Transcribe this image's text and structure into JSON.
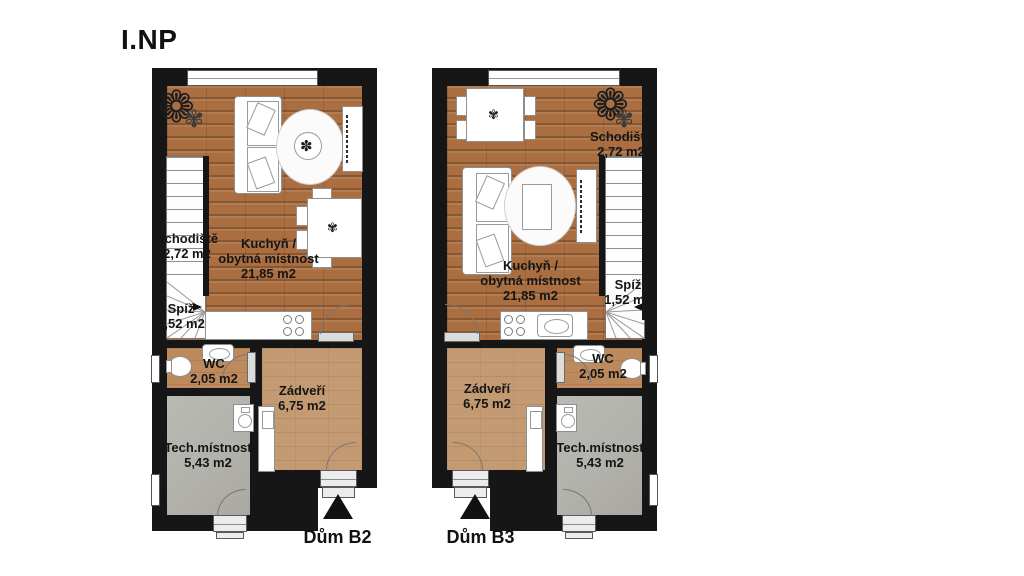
{
  "title": "I.NP",
  "units": [
    {
      "house_label": "Dům B2",
      "rooms": {
        "schodiste": {
          "name": "Schodiště",
          "area": "2,72 m2"
        },
        "kuchyn": {
          "line1": "Kuchyň /",
          "line2": "obytná místnost",
          "area": "21,85 m2"
        },
        "spiz": {
          "name": "Spíž",
          "area": "1,52 m2"
        },
        "wc": {
          "name": "WC",
          "area": "2,05 m2"
        },
        "zadveri": {
          "name": "Zádveří",
          "area": "6,75 m2"
        },
        "tech": {
          "name": "Tech.místnost",
          "area": "5,43 m2"
        }
      }
    },
    {
      "house_label": "Dům B3",
      "rooms": {
        "schodiste": {
          "name": "Schodiště",
          "area": "2,72 m2"
        },
        "kuchyn": {
          "line1": "Kuchyň /",
          "line2": "obytná místnost",
          "area": "21,85 m2"
        },
        "spiz": {
          "name": "Spíž",
          "area": "1,52 m2"
        },
        "wc": {
          "name": "WC",
          "area": "2,05 m2"
        },
        "zadveri": {
          "name": "Zádveří",
          "area": "6,75 m2"
        },
        "tech": {
          "name": "Tech.místnost",
          "area": "5,43 m2"
        }
      }
    }
  ],
  "icons": {
    "plant": "❁",
    "plant_small": "✾",
    "table_plant": "✽",
    "centerpiece": "✾"
  },
  "colors": {
    "wall": "#161616",
    "wood": "#aa6e40",
    "hall_floor": "#c49a72",
    "wc_floor": "#bd8a5e",
    "tech_floor": "#b5b4ae"
  }
}
